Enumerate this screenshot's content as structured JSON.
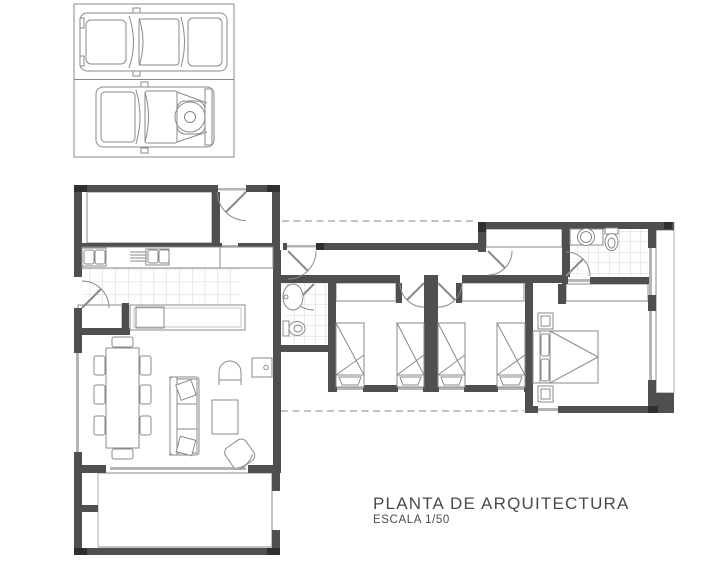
{
  "title_block": {
    "title": "PLANTA DE ARQUITECTURA",
    "scale_label": "ESCALA 1/50"
  },
  "drawing": {
    "type": "architectural-floor-plan-top-view",
    "colors": {
      "bg": "#ffffff",
      "wall": "#4f4f4f",
      "wall_dark": "#2f2f2f",
      "line": "#8a8a8a",
      "line_light": "#b5b5b5",
      "tile": "#cbcbcb",
      "hatch": "#9b9b9b",
      "deck_stripe": "#adadad",
      "dash": "#9e9e9e",
      "text": "#4a4a4a"
    },
    "elements": [
      "carport-with-two-vehicles",
      "pickup-truck-top-view",
      "suv-with-spare-tire-top-view",
      "north-patio-deck",
      "entry-door",
      "kitchen-counter-with-double-sinks",
      "kitchen-island-with-cooktop",
      "dining-table-with-eight-chairs",
      "sofa-with-throw-pillows",
      "armchair",
      "coffee-table",
      "lounge-chair",
      "wood-stove-box",
      "small-bathroom-sink-and-toilet",
      "corridor",
      "bedroom-1-with-two-single-beds-and-closet",
      "bedroom-2-with-two-single-beds-and-closet",
      "master-bathroom-sink-and-toilet",
      "master-bedroom-with-double-bed-and-closet",
      "east-deck-walkway",
      "south-wood-deck",
      "roof-overhang-dashed-lines"
    ]
  }
}
